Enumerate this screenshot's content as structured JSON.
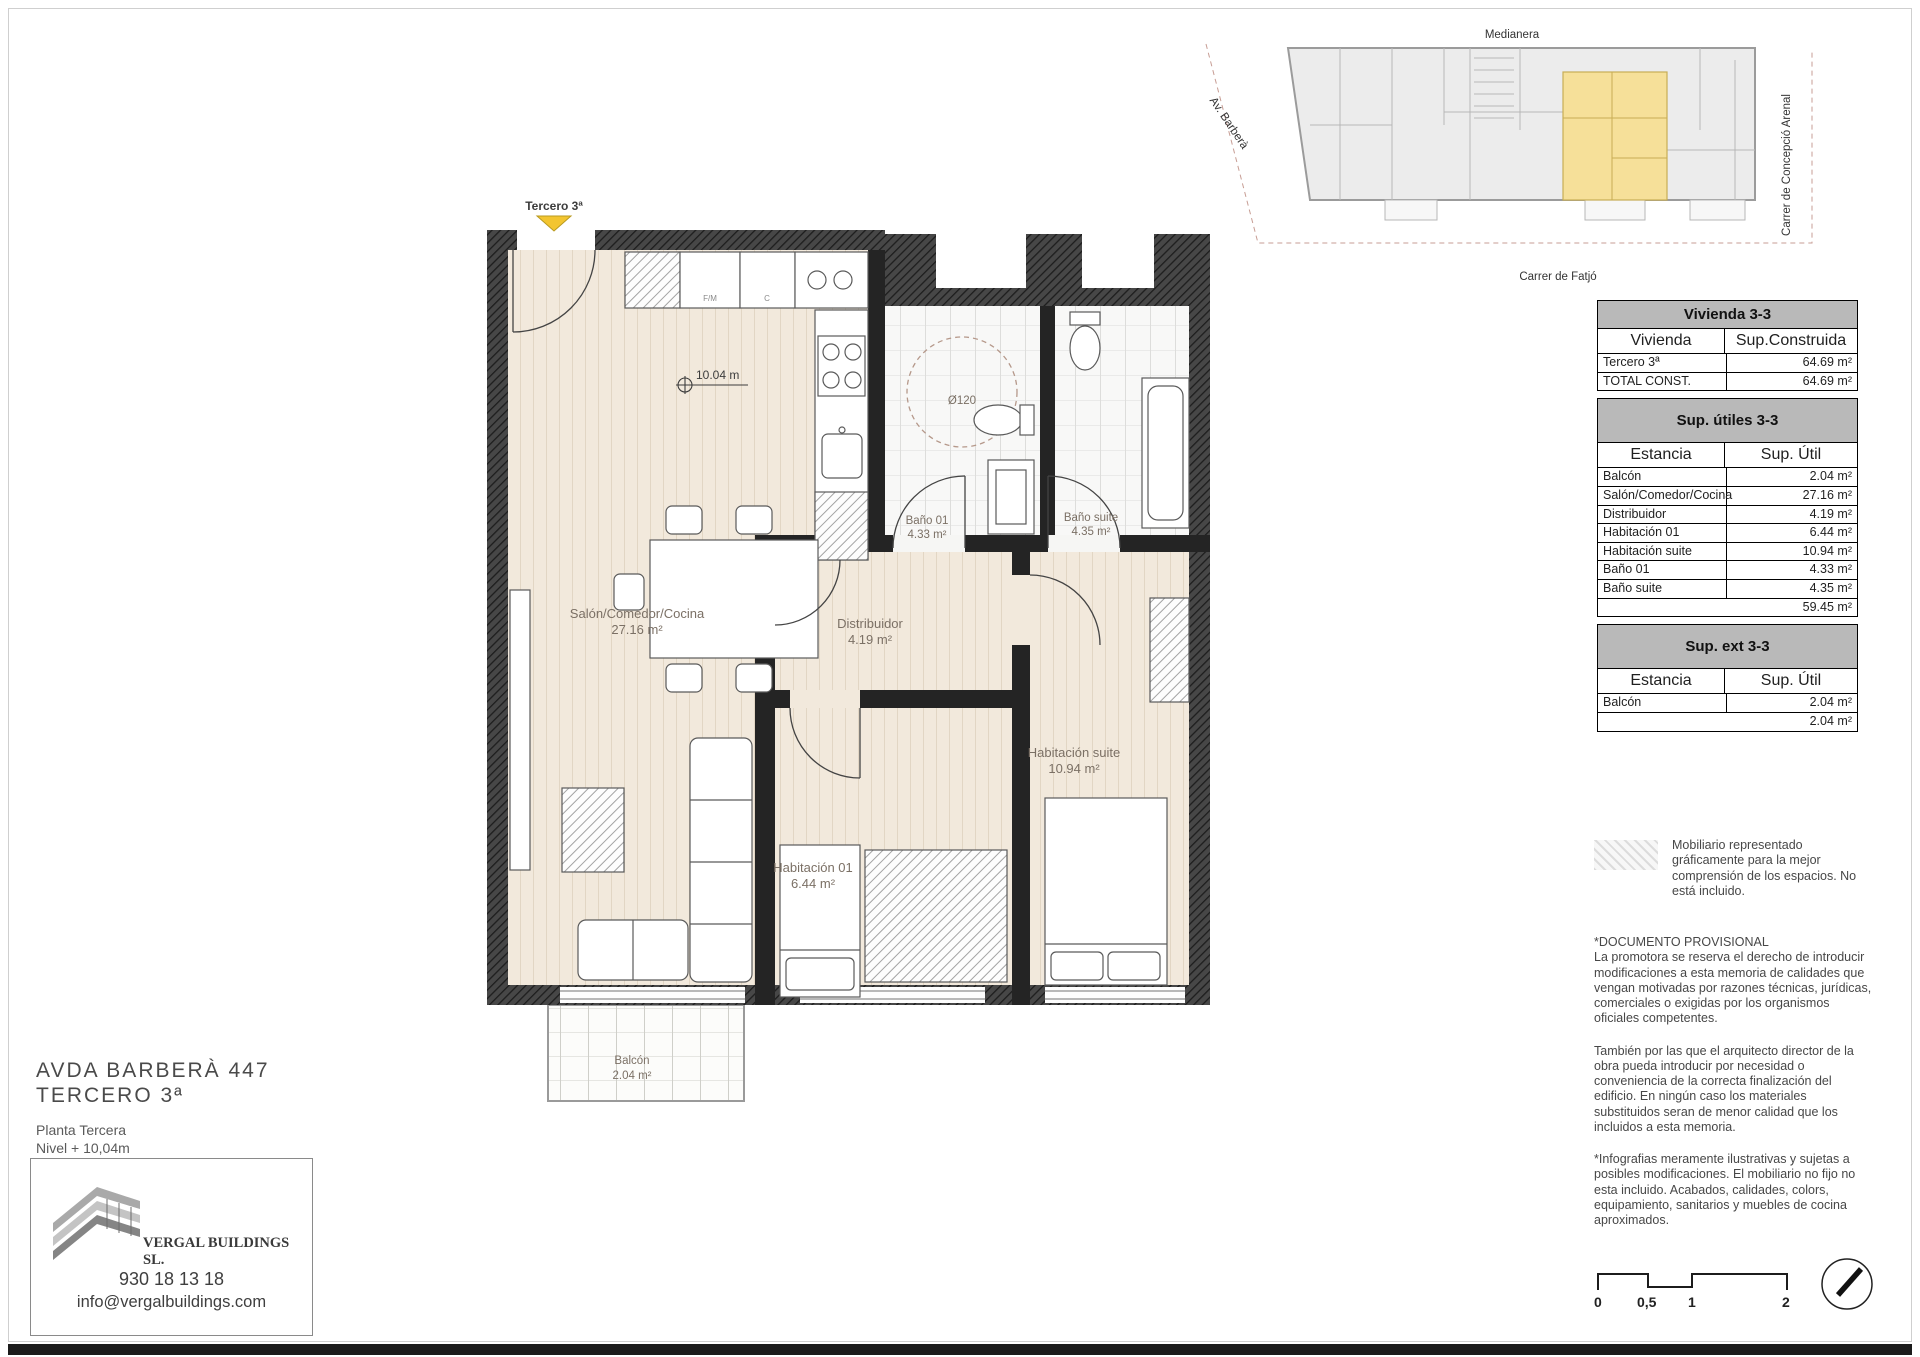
{
  "site_map": {
    "label_top": "Medianera",
    "label_left": "Av. Barberà",
    "label_right": "Carrer de Concepció Arenal",
    "label_bottom": "Carrer de Fatjó",
    "highlight_color": "#f6e099"
  },
  "plan": {
    "marker": "Tercero 3ª",
    "marker_color": "#f3c530",
    "level_mark": "10.04 m",
    "turning_circle": "Ø120",
    "kitchen": {
      "fridge": "F/M",
      "column": "C"
    },
    "rooms": {
      "salon": {
        "name": "Salón/Comedor/Cocina",
        "area": "27.16 m²"
      },
      "banio01": {
        "name": "Baño 01",
        "area": "4.33 m²"
      },
      "banio_suite": {
        "name": "Baño suite",
        "area": "4.35 m²"
      },
      "distribuidor": {
        "name": "Distribuidor",
        "area": "4.19 m²"
      },
      "hab_suite": {
        "name": "Habitación suite",
        "area": "10.94 m²"
      },
      "hab01": {
        "name": "Habitación 01",
        "area": "6.44 m²"
      },
      "balcon": {
        "name": "Balcón",
        "area": "2.04 m²"
      }
    }
  },
  "tables": {
    "vivienda": {
      "title": "Vivienda 3-3",
      "col_room": "Vivienda",
      "col_area": "Sup.Construida",
      "rows": [
        {
          "name": "Tercero 3ª",
          "value": "64.69 m²"
        },
        {
          "name": "TOTAL CONST.",
          "value": "64.69 m²"
        }
      ]
    },
    "utiles": {
      "title": "Sup. útiles 3-3",
      "col_room": "Estancia",
      "col_area": "Sup. Útil",
      "rows": [
        {
          "name": "Balcón",
          "value": "2.04 m²"
        },
        {
          "name": "Salón/Comedor/Cocina",
          "value": "27.16 m²"
        },
        {
          "name": "Distribuidor",
          "value": "4.19 m²"
        },
        {
          "name": "Habitación 01",
          "value": "6.44 m²"
        },
        {
          "name": "Habitación suite",
          "value": "10.94 m²"
        },
        {
          "name": "Baño 01",
          "value": "4.33 m²"
        },
        {
          "name": "Baño suite",
          "value": "4.35 m²"
        }
      ],
      "total": "59.45 m²"
    },
    "ext": {
      "title": "Sup. ext 3-3",
      "col_room": "Estancia",
      "col_area": "Sup. Útil",
      "rows": [
        {
          "name": "Balcón",
          "value": "2.04 m²"
        }
      ],
      "total": "2.04 m²"
    }
  },
  "notes": {
    "legend": "Mobiliario representado gráficamente para la mejor comprensión de los espacios. No está incluido.",
    "provisional": "*DOCUMENTO PROVISIONAL\nLa promotora se reserva el derecho de introducir modificaciones a esta memoria de calidades que vengan motivadas por razones técnicas, jurídicas, comerciales o exigidas por los  organismos oficiales competentes.",
    "tambien": "También por las que el arquitecto director de la obra pueda introducir por necesidad o conveniencia de la correcta finalización del edificio. En ningún caso los materiales substituidos seran de menor calidad que los incluidos a esta memoria.",
    "infografias": "*Infografias meramente ilustrativas y sujetas a posibles modificaciones. El mobiliario no fijo no esta incluido. Acabados, calidades, colors, equipamiento, sanitarios y muebles de cocina aproximados."
  },
  "title_block": {
    "address_line1": "AVDA BARBERÀ 447",
    "address_line2": "TERCERO 3ª",
    "floor": "Planta Tercera",
    "level": "Nivel + 10,04m",
    "company": "VERGAL BUILDINGS SL.",
    "phone": "930 18 13 18",
    "email": "info@vergalbuildings.com"
  },
  "scale_bar": {
    "labels": [
      "0",
      "0,5",
      "1",
      "2"
    ]
  }
}
